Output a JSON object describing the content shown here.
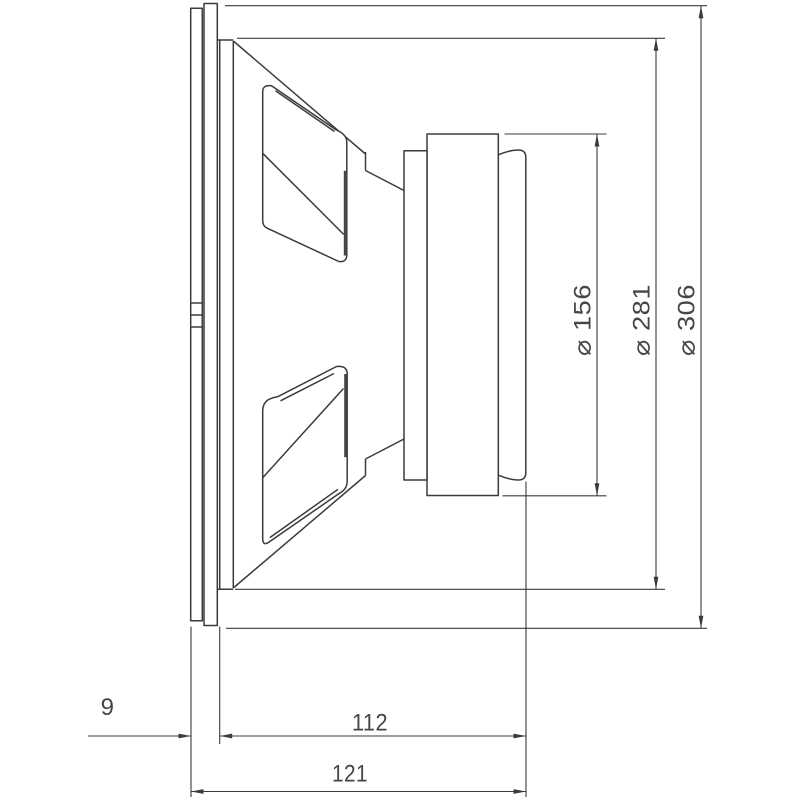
{
  "drawing": {
    "kind": "technical dimension drawing, loudspeaker side view",
    "colors": {
      "background": "#ffffff",
      "line": "#3b3b3b",
      "text": "#464646",
      "dark_fill": "#454545"
    },
    "dimensions": {
      "dia_magnet": {
        "label": "⌀ 156",
        "value": 156,
        "type": "diameter"
      },
      "dia_frame": {
        "label": "⌀ 281",
        "value": 281,
        "type": "diameter"
      },
      "dia_outer": {
        "label": "⌀ 306",
        "value": 306,
        "type": "diameter"
      },
      "gasket_thickness": {
        "label": "9",
        "value": 9,
        "type": "linear"
      },
      "depth_body": {
        "label": "112",
        "value": 112,
        "type": "linear"
      },
      "depth_total": {
        "label": "121",
        "value": 121,
        "type": "linear"
      }
    }
  }
}
